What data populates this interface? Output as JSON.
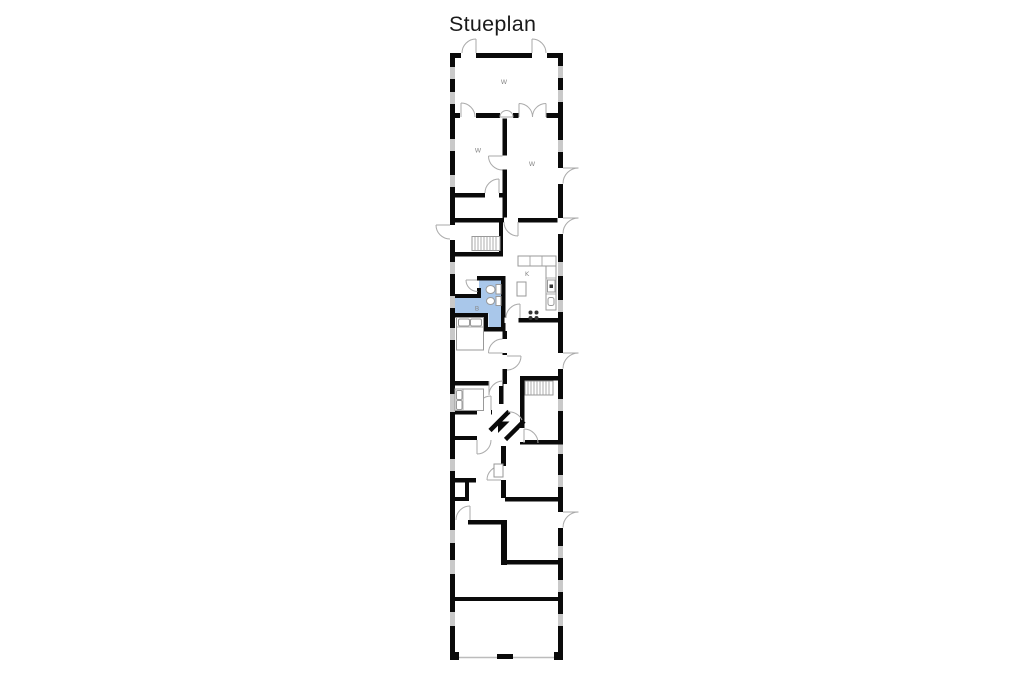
{
  "title": "Stueplan",
  "room_labels": [
    {
      "id": "storage-top",
      "text": "W"
    },
    {
      "id": "room-left",
      "text": "W"
    },
    {
      "id": "room-right",
      "text": "W"
    },
    {
      "id": "kitchen",
      "text": "K"
    },
    {
      "id": "bathroom",
      "text": "B"
    }
  ],
  "colors": {
    "wall": "#0a0a0a",
    "window": "#c9c9c9",
    "door_arc": "#aaaaaa",
    "furniture": "#999999",
    "highlight": "#a9c7ea",
    "title_text": "#1a1a1a",
    "label_text": "#8a8a8a"
  }
}
